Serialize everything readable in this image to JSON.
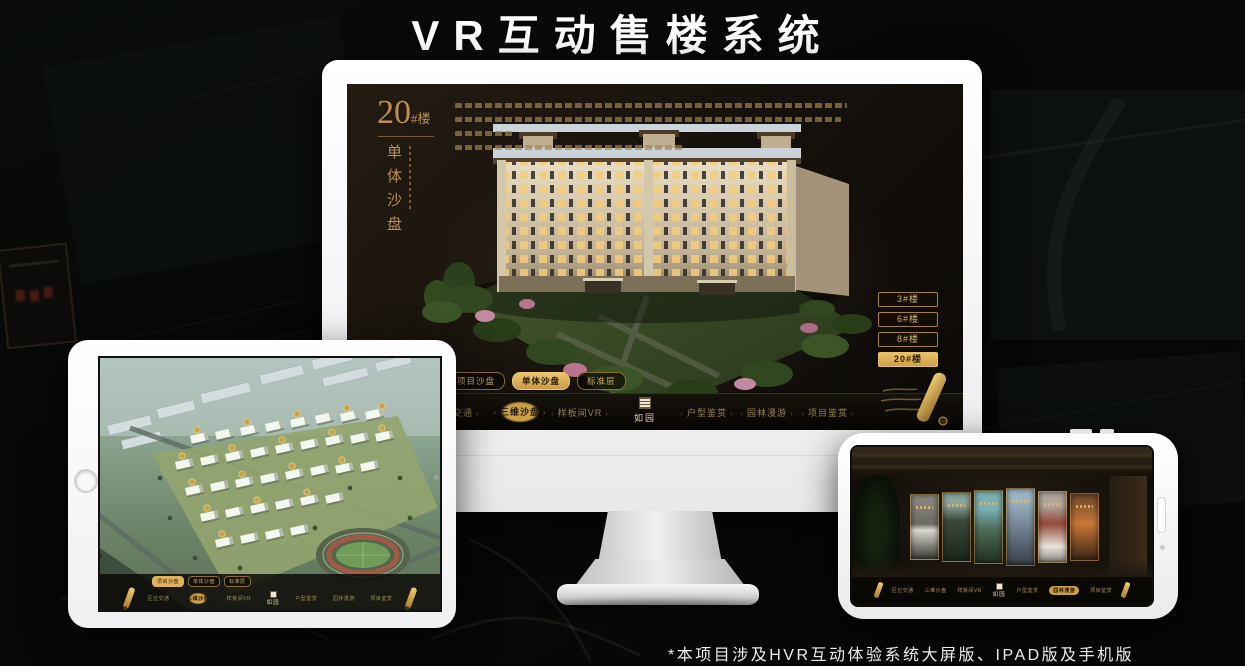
{
  "title": "VR互动售楼系统",
  "footer_note": "*本项目涉及HVR互动体验系统大屏版、IPAD版及手机版",
  "accent_gold": "#c9a45c",
  "monitor": {
    "panel_title_num": "20",
    "panel_title_suffix": "#楼",
    "panel_subtitle": "单体沙盘",
    "floor_buttons": [
      {
        "label": "3#楼",
        "active": false
      },
      {
        "label": "6#楼",
        "active": false
      },
      {
        "label": "8#楼",
        "active": false
      },
      {
        "label": "20#楼",
        "active": true
      }
    ],
    "sub_tabs": [
      {
        "label": "项目沙盘",
        "active": false
      },
      {
        "label": "单体沙盘",
        "active": true
      },
      {
        "label": "标准层",
        "active": false
      }
    ],
    "nav": {
      "items_left": [
        {
          "label": "区位交通",
          "active": false
        },
        {
          "label": "三维沙盘",
          "active": true
        },
        {
          "label": "样板间VR",
          "active": false
        }
      ],
      "logo": "如园",
      "items_right": [
        {
          "label": "户型鉴赏",
          "active": false
        },
        {
          "label": "园林漫游",
          "active": false
        },
        {
          "label": "项目鉴赏",
          "active": false
        }
      ]
    }
  },
  "tablet": {
    "sub_tabs": [
      {
        "label": "项目沙盘",
        "active": true
      },
      {
        "label": "单体沙盘",
        "active": false
      },
      {
        "label": "标准层",
        "active": false
      }
    ],
    "nav": {
      "items_left": [
        {
          "label": "区位交通",
          "active": false
        },
        {
          "label": "三维沙盘",
          "active": true
        },
        {
          "label": "样板间VR",
          "active": false
        }
      ],
      "logo": "如园",
      "items_right": [
        {
          "label": "户型鉴赏",
          "active": false
        },
        {
          "label": "园林漫游",
          "active": false
        },
        {
          "label": "项目鉴赏",
          "active": false
        }
      ]
    }
  },
  "phone": {
    "nav": {
      "items_left": [
        {
          "label": "区位交通",
          "active": false
        },
        {
          "label": "三维沙盘",
          "active": false
        },
        {
          "label": "样板间VR",
          "active": false
        }
      ],
      "logo": "如园",
      "items_right": [
        {
          "label": "户型鉴赏",
          "active": false
        },
        {
          "label": "园林漫游",
          "active": true
        },
        {
          "label": "项目鉴赏",
          "active": false
        }
      ]
    }
  }
}
